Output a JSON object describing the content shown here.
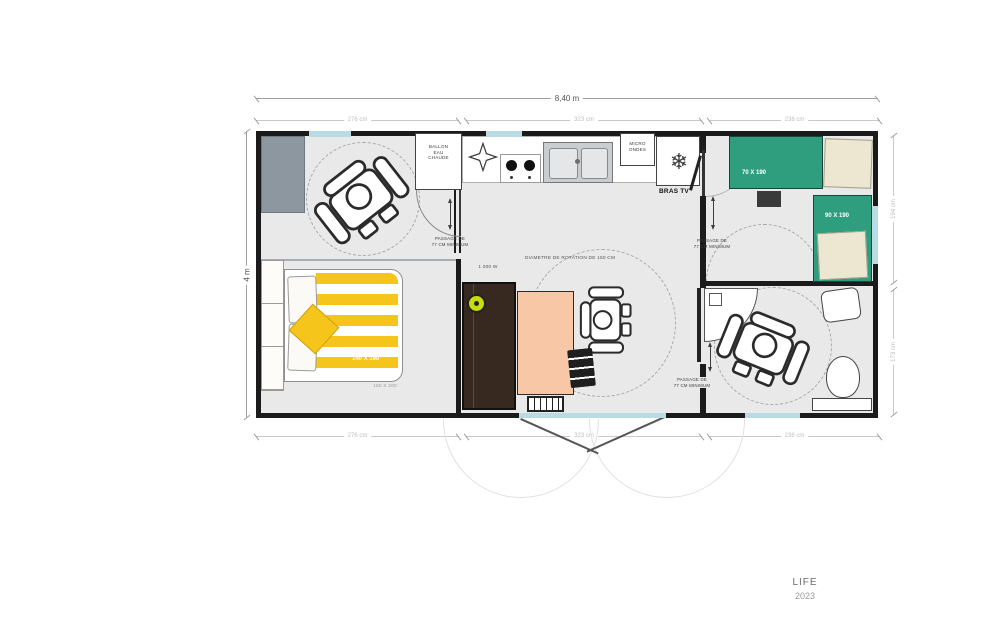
{
  "title": "accessible-mobile-home-floor-plan",
  "brand": {
    "name": "LIFE",
    "year": "2023"
  },
  "dims": {
    "total_width": "8,40 m",
    "total_height": "4 m",
    "top": [
      "276 cm",
      "323 cm",
      "238 cm"
    ],
    "bottom": [
      "276 cm",
      "323 cm",
      "238 cm"
    ],
    "right": [
      "194 cm",
      "173 cm"
    ]
  },
  "labels": {
    "water_heater": [
      "BALLON",
      "EAU",
      "CHAUDE"
    ],
    "microwave": [
      "MICRO",
      "ONDES"
    ],
    "tv_arm": "BRAS TV",
    "passage": [
      "PASSAGE DE",
      "77 CM MINIMUM"
    ],
    "rotation": "DIAMETRE DE ROTATION DE 150 CM",
    "power": "1 000 W"
  },
  "beds": {
    "double": "140 X 190",
    "double_alt": "160 X 200",
    "single_small": "70 X 190",
    "single_large": "90 X 190"
  },
  "icons": [
    "wheelchair-user-icon",
    "snowflake-icon",
    "vent-star-icon"
  ],
  "colors": {
    "wall": "#1b1b1b",
    "floor": "#e9e9e9",
    "bed_teal": "#2f9e7f",
    "pillow_cream": "#ede6d0",
    "duvet_yellow": "#f6c51c",
    "table_peach": "#f8c7a6",
    "wardrobe_brown": "#37291f",
    "window_blue": "#b9dbe4",
    "badge_green": "#c9dc0c"
  }
}
